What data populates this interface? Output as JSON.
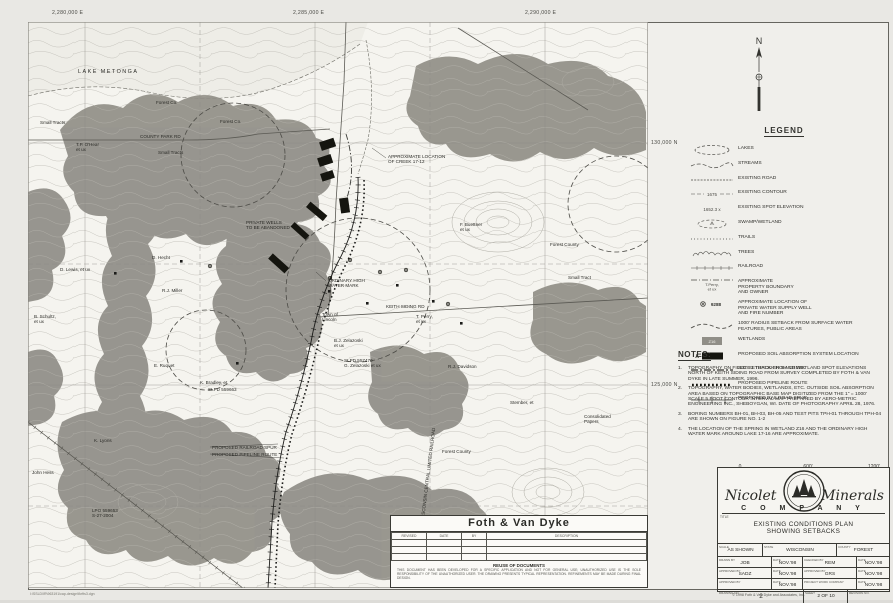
{
  "sheet": {
    "top_coords": [
      "2,280,000 E",
      "2,285,000 E",
      "2,290,000 E"
    ],
    "right_coords": [
      "130,000 N",
      "125,000 N"
    ],
    "file_path": "I:\\SSLD\\IR\\963191\\cap-design\\fkrfts3.dgn"
  },
  "north": {
    "label": "N"
  },
  "legend": {
    "title": "LEGEND",
    "items": [
      {
        "symbol": "lakes",
        "label": "LAKES"
      },
      {
        "symbol": "streams",
        "label": "STREAMS"
      },
      {
        "symbol": "existing-road",
        "label": "EXISTING ROAD"
      },
      {
        "symbol": "existing-contour",
        "label": "EXISTING CONTOUR",
        "sym_text": "1675"
      },
      {
        "symbol": "spot-elevation",
        "label": "EXISTING SPOT ELEVATION",
        "sym_text": "1652.3 x"
      },
      {
        "symbol": "swamp-wetland",
        "label": "SWAMP/WETLAND"
      },
      {
        "symbol": "trails",
        "label": "TRAILS"
      },
      {
        "symbol": "trees",
        "label": "TREES"
      },
      {
        "symbol": "railroad",
        "label": "RAILROAD"
      },
      {
        "symbol": "property-boundary",
        "label": "APPROXIMATE\nPROPERTY BOUNDARY\nAND OWNER",
        "sym_text": "T.Perry,\net ux"
      },
      {
        "symbol": "well",
        "label": "APPROXIMATE LOCATION OF\nPRIVATE WATER SUPPLY WELL\nAND FIRE NUMBER",
        "sym_text": "9288"
      },
      {
        "symbol": "radius-setback",
        "label": "1000' RADIUS SETBACK FROM SURFACE WATER\nFEATURES, PUBLIC AREAS"
      },
      {
        "symbol": "wetlands",
        "label": "WETLANDS",
        "sym_text": "Z16"
      },
      {
        "symbol": "soil-absorption",
        "label": "PROPOSED SOIL ABSORPTION SYSTEM LOCATION",
        "sym_text": "A"
      },
      {
        "symbol": "creek-setback",
        "label": "300' SETBACK FROM CREEK"
      },
      {
        "symbol": "pipeline",
        "label": "PROPOSED PIPELINE ROUTE"
      },
      {
        "symbol": "railroad-spur",
        "label": "PROPOSED RAILROAD SPUR"
      }
    ]
  },
  "notes": {
    "title": "NOTES:",
    "items": [
      "TOPOGRAPHY ON FIELDS 1 THROUGH 5 AND WETLAND SPOT ELEVATIONS NORTH OF KEITH SIDING ROAD FROM SURVEY COMPLETED BY FOTH & VAN DYKE IN LATE SUMMER, 1996.",
      "TOPOGRAPHY, WATER BODIES, WETLANDS, ETC. OUTSIDE SOIL ABSORPTION AREA BASED ON TOPOGRAPHIC BASE MAP DIGITIZED FROM THE 1\" = 1000' SCALE 5 FOOT CONTOUR INTERVAL MAP PREPARED BY AERO-METRIC ENGINEERING INC., SHEBOYGAN, WI. DATE OF PHOTOGRAPHY APRIL 28, 1976.",
      "BORING NUMBERS BH-01, BH-03, BH-05 AND TEST PITS TPH-01 THROUGH TPH-04 ARE SHOWN ON FIGURE NO. 1-2",
      "THE LOCATION OF THE SPRING IN WETLAND Z16 AND THE ORDINARY HIGH WATER MARK AROUND LAKE 17-16 ARE APPROXIMATE."
    ]
  },
  "scale_bar": {
    "labels": [
      "0",
      "600'",
      "1200'"
    ]
  },
  "company_block": {
    "name_left": "Nicolet",
    "name_right": "Minerals",
    "company": "C O M P A N Y",
    "title_label": "TITLE",
    "title_line1": "EXISTING CONDITIONS PLAN",
    "title_line2": "SHOWING SETBACKS",
    "copyright": "© 1998 Foth & Van Dyke and Associates, Inc.",
    "tb": {
      "scale_l": "SCALE",
      "scale_v": "AS SHOWN",
      "state_l": "STATE",
      "state_v": "WISCONSIN",
      "county_l": "COUNTY",
      "county_v": "FOREST",
      "drawn_l": "DRAWN BY",
      "drawn_v": "JOB",
      "date_l": "DATE",
      "d1": "NOV.'98",
      "d2": "NOV.'98",
      "d3": "NOV.'98",
      "d4": "NOV.'98",
      "d5": "NOV.'98",
      "d6": "NOV.'98",
      "checked_l": "CHECKED BY",
      "checked_v": "REM",
      "appr1_l": "APPROVED BY",
      "appr1_v": "SADZ",
      "appr2_l": "APPROVED BY",
      "appr2_v": "GRS",
      "appr3_l": "APPROVED BY",
      "appr3_v": "",
      "pwc_l": "PROJECT WORK COMPANY",
      "pwc_v": "",
      "dwg_l": "DRAWING NO.",
      "dwg_v": "2",
      "sheet_l": "SHEET",
      "sheet_v": "2  OF  10",
      "rev_l": "REVISION NO.",
      "rev_v": ""
    }
  },
  "foth_block": {
    "name": "Foth & Van Dyke",
    "rev_headers": [
      "REVISED",
      "DATE",
      "BY",
      "DESCRIPTION"
    ],
    "reuse_title": "REUSE OF DOCUMENTS",
    "reuse_text": "THIS DOCUMENT HAS BEEN DEVELOPED FOR A SPECIFIC APPLICATION AND NOT FOR GENERAL USE; UNAUTHORIZED USE IS THE SOLE RESPONSIBILITY OF THE UNAUTHORIZED USER. THE DRAWING PRESENTS TYPICAL REPRESENTATION. REFINEMENTS MAY BE MADE DURING FINAL DESIGN."
  },
  "map": {
    "labels": [
      {
        "text": "LAKE METONGA",
        "x": 50,
        "y": 48,
        "ls": 1.5
      },
      {
        "text": "Forest Co.",
        "x": 128,
        "y": 78
      },
      {
        "text": "Forest Co.",
        "x": 192,
        "y": 97
      },
      {
        "text": "Small Tracts",
        "x": 12,
        "y": 98
      },
      {
        "text": "Small Tracts",
        "x": 130,
        "y": 128
      },
      {
        "text": "COUNTY PARK RD",
        "x": 112,
        "y": 112
      },
      {
        "text": "T.P. O'Hear\net ux",
        "x": 48,
        "y": 120
      },
      {
        "text": "D. Lewis, et ux",
        "x": 32,
        "y": 245
      },
      {
        "text": "D. Hecht",
        "x": 124,
        "y": 233
      },
      {
        "text": "R.J. Miller",
        "x": 134,
        "y": 266
      },
      {
        "text": "B. Schultz,\net ux",
        "x": 6,
        "y": 292
      },
      {
        "text": "E. Ruquet",
        "x": 126,
        "y": 341
      },
      {
        "text": "K. Bradley, et",
        "x": 172,
        "y": 358
      },
      {
        "text": "SLPD 559663",
        "x": 180,
        "y": 365
      },
      {
        "text": "K. Lyons",
        "x": 66,
        "y": 416
      },
      {
        "text": "John Hess",
        "x": 4,
        "y": 448
      },
      {
        "text": "LPO 559653\nS-27-2004",
        "x": 64,
        "y": 486
      },
      {
        "text": "PROPOSED RAILROAD SPUR",
        "x": 184,
        "y": 423
      },
      {
        "text": "PROPOSED PIPELINE ROUTE",
        "x": 184,
        "y": 430
      },
      {
        "text": "Town of\nLincoln",
        "x": 294,
        "y": 290
      },
      {
        "text": "KEITH SIDING RD",
        "x": 358,
        "y": 282
      },
      {
        "text": "B.J. Zelazoski\net ux",
        "x": 306,
        "y": 316
      },
      {
        "text": "SLPD 557470\nG. Zelazoski et ux",
        "x": 316,
        "y": 336
      },
      {
        "text": "R.J. Davidson",
        "x": 420,
        "y": 342
      },
      {
        "text": "T. Perry,\net ux",
        "x": 388,
        "y": 292
      },
      {
        "text": "F. Buettner\net ux",
        "x": 432,
        "y": 200
      },
      {
        "text": "Forest County",
        "x": 522,
        "y": 220
      },
      {
        "text": "Small Tract",
        "x": 540,
        "y": 253
      },
      {
        "text": "Forest County",
        "x": 414,
        "y": 427
      },
      {
        "text": "Stember, et",
        "x": 482,
        "y": 378
      },
      {
        "text": "Consolidated\nPapers",
        "x": 556,
        "y": 392
      },
      {
        "text": "PRIVATE WELLS\nTO BE ABANDONED",
        "x": 218,
        "y": 198
      },
      {
        "text": "APPROXIMATE LOCATION\nOF CREEK 17-12",
        "x": 360,
        "y": 132
      },
      {
        "text": "ORDINARY HIGH\nWATER MARK",
        "x": 300,
        "y": 256
      },
      {
        "text": "WISCONSIN CENTRAL LIMITED RAILROAD",
        "x": 392,
        "y": 498,
        "rot": -83
      }
    ]
  }
}
